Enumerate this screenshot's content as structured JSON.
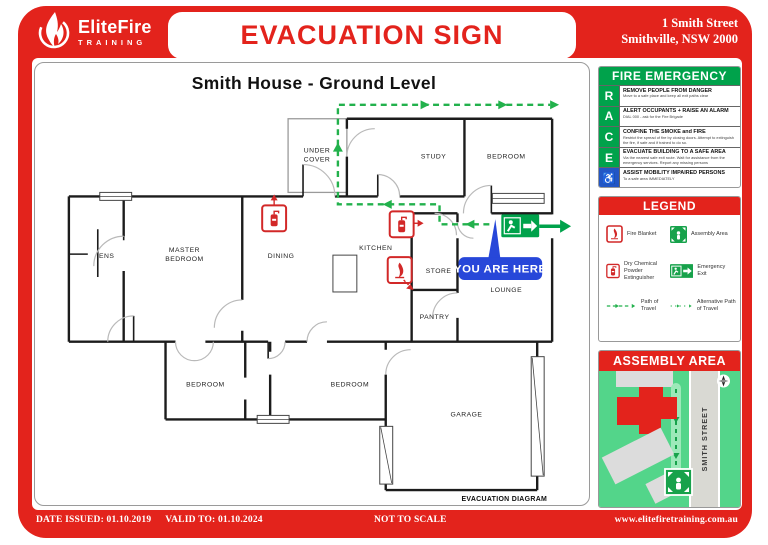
{
  "colors": {
    "red": "#E3231C",
    "green": "#00A24B",
    "path_green": "#22B14C",
    "badge_blue": "#2747D9",
    "wheelchair_blue": "#2356C5",
    "map_green": "#53D58A",
    "road_grey": "#D9D9D3",
    "building_grey": "#DCDCDC"
  },
  "header": {
    "brand": "EliteFire",
    "brand_sub": "TRAINING",
    "title": "EVACUATION SIGN",
    "address1": "1 Smith Street",
    "address2": "Smithville, NSW 2000"
  },
  "plan": {
    "title": "Smith House  - Ground Level",
    "footnote": "EVACUATION DIAGRAM",
    "you_are_here": "YOU ARE HERE",
    "rooms": {
      "under1": "UNDER",
      "under2": "COVER",
      "study": "STUDY",
      "bedroom_ne": "BEDROOM",
      "ens": "ENS",
      "master1": "MASTER",
      "master2": "BEDROOM",
      "dining": "DINING",
      "kitchen": "KITCHEN",
      "store": "STORE",
      "pantry": "PANTRY",
      "lounge": "LOUNGE",
      "bedroom_sw": "BEDROOM",
      "bedroom_s": "BEDROOM",
      "garage": "GARAGE"
    }
  },
  "race": {
    "title": "FIRE EMERGENCY",
    "rows": [
      {
        "letter": "R",
        "heading": "REMOVE PEOPLE FROM DANGER",
        "detail": "Move to a safe place and keep all exit paths clear"
      },
      {
        "letter": "A",
        "heading": "ALERT OCCUPANTS + RAISE AN ALARM",
        "detail": "DIAL 000 - ask for the Fire Brigade"
      },
      {
        "letter": "C",
        "heading": "CONFINE THE SMOKE and FIRE",
        "detail": "Restrict the spread of fire by closing doors. Attempt to extinguish the fire, if safe and if trained to do so."
      },
      {
        "letter": "E",
        "heading": "EVACUATE BUILDING TO A SAFE AREA",
        "detail": "Via the nearest safe exit route. Wait for assistance from the emergency services. Report any missing persons"
      },
      {
        "letter": "♿",
        "heading": "ASSIST MOBILITY IMPAIRED PERSONS",
        "detail": "To a safe area IMMEDIATELY"
      }
    ]
  },
  "legend": {
    "title": "LEGEND",
    "items": [
      {
        "label": "Fire Blanket",
        "icon": "fire-blanket-icon"
      },
      {
        "label": "Assembly Area",
        "icon": "assembly-area-icon"
      },
      {
        "label": "Dry Chemical Powder Extinguisher",
        "icon": "extinguisher-icon"
      },
      {
        "label": "Emergency Exit",
        "icon": "emergency-exit-icon"
      },
      {
        "label": "Path of Travel",
        "icon": "path-of-travel-icon"
      },
      {
        "label": "Alternative Path of Travel",
        "icon": "alt-path-of-travel-icon"
      }
    ]
  },
  "assembly": {
    "title": "ASSEMBLY AREA",
    "street": "SMITH STREET"
  },
  "footer": {
    "date_issued": "DATE ISSUED: 01.10.2019",
    "valid_to": "VALID TO: 01.10.2024",
    "scale_note": "NOT TO SCALE",
    "website": "www.elitefiretraining.com.au"
  }
}
